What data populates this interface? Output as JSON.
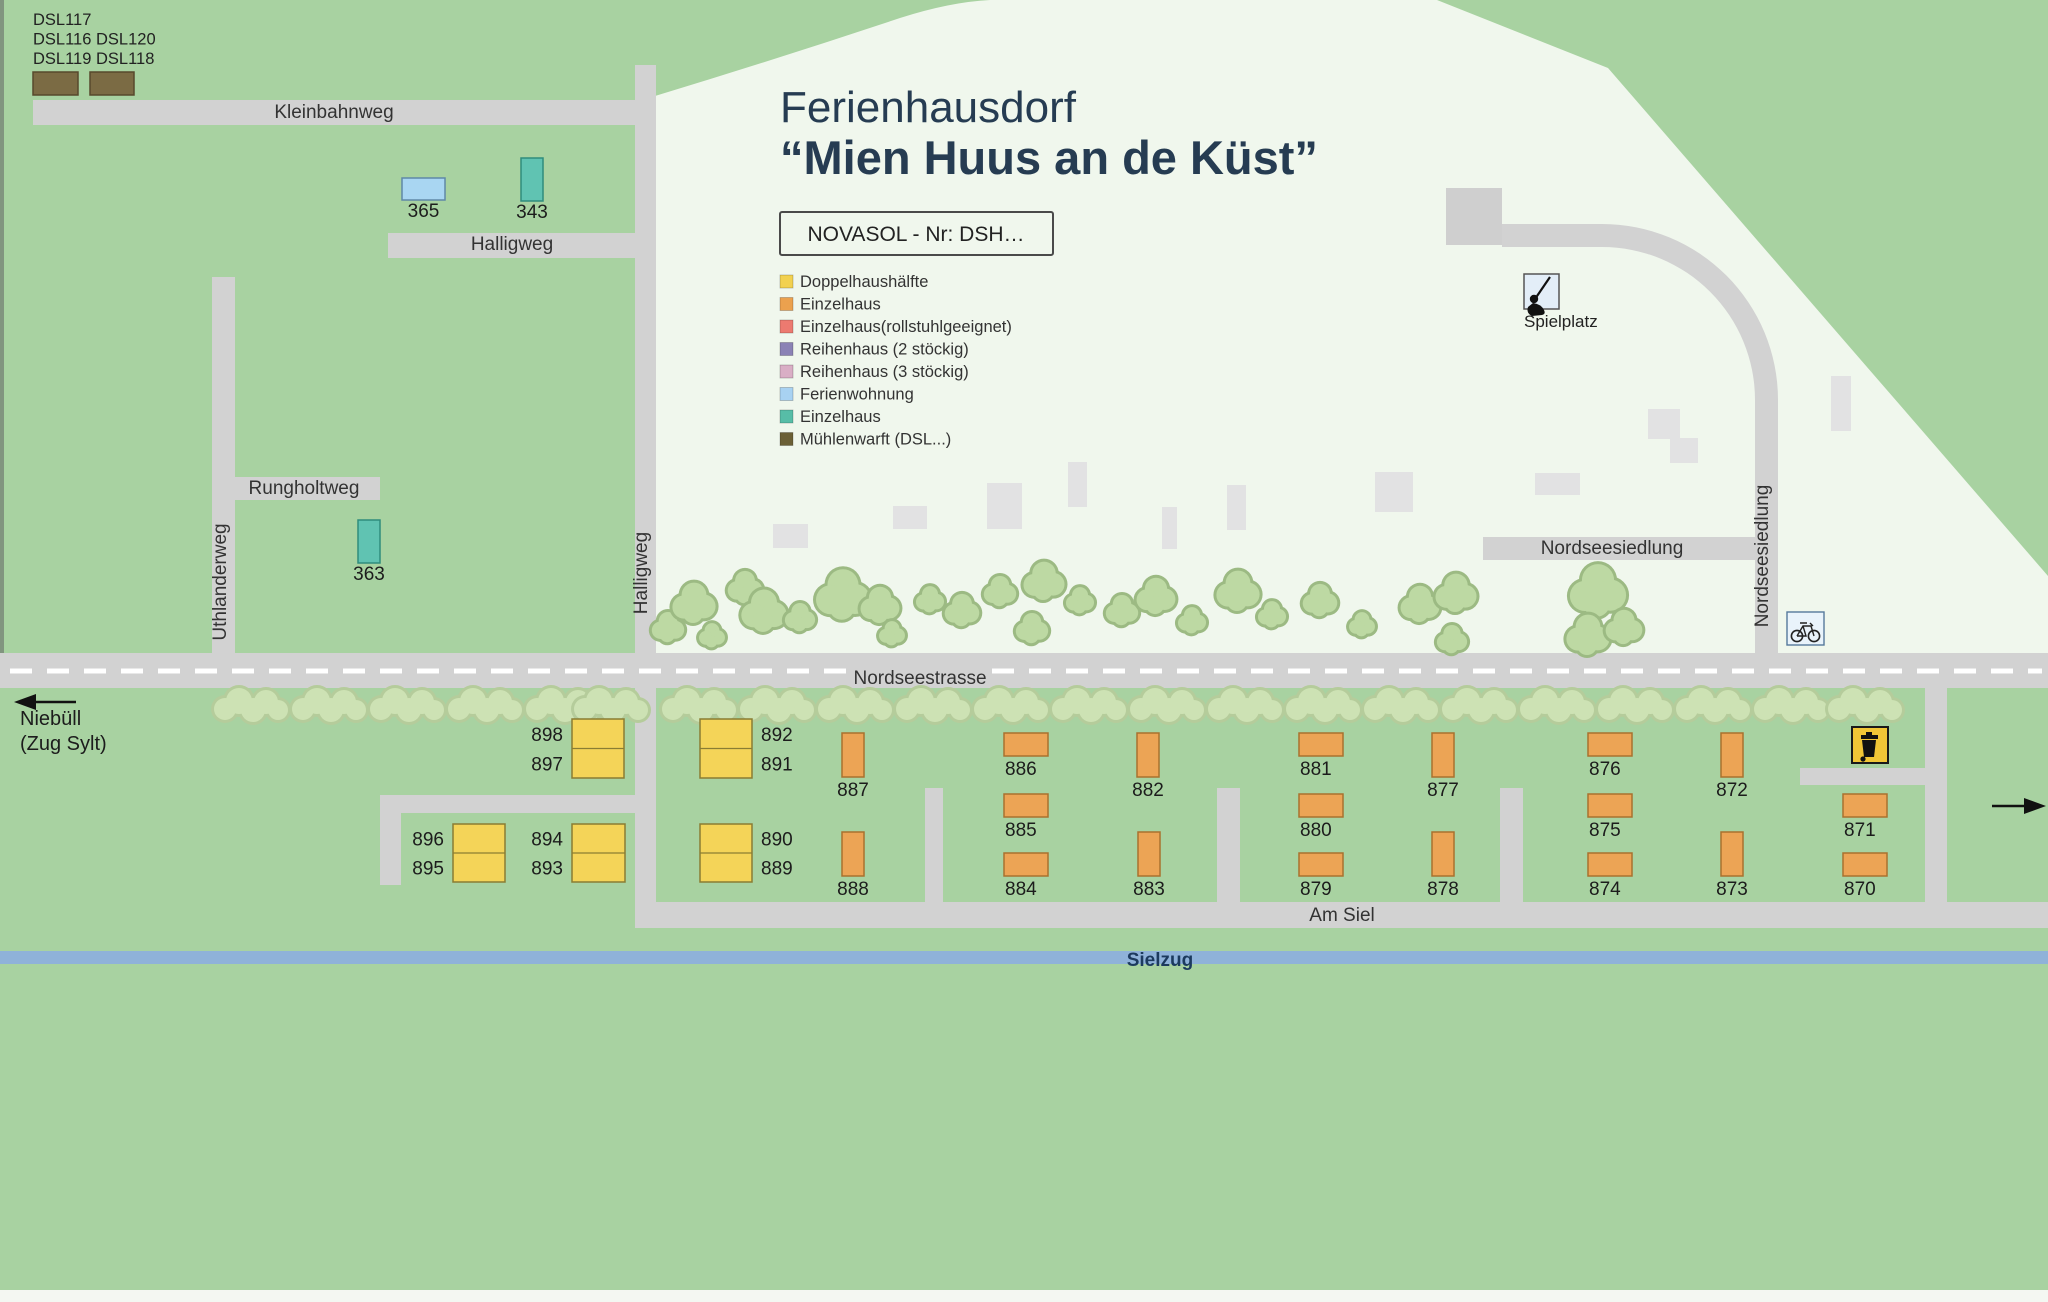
{
  "title": {
    "line1": "Ferienhausdorf",
    "line2": "“Mien Huus an de Küst”"
  },
  "novasol": {
    "label": "NOVASOL - Nr: DSH…"
  },
  "legend": {
    "items": [
      {
        "label": "Doppelhaushälfte",
        "color": "#f2d150"
      },
      {
        "label": "Einzelhaus",
        "color": "#eba14e"
      },
      {
        "label": "Einzelhaus(rollstuhlgeeignet)",
        "color": "#ec7a70"
      },
      {
        "label": "Reihenhaus (2 stöckig)",
        "color": "#8b82b5"
      },
      {
        "label": "Reihenhaus (3 stöckig)",
        "color": "#d9aec5"
      },
      {
        "label": "Ferienwohnung",
        "color": "#a8d2f2"
      },
      {
        "label": "Einzelhaus",
        "color": "#57bda7"
      },
      {
        "label": "Mühlenwarft (DSL...)",
        "color": "#6b6036"
      }
    ]
  },
  "dsl_block": {
    "lines": [
      "DSL117",
      "DSL116 DSL120",
      "DSL119 DSL118"
    ]
  },
  "directions": {
    "west_line1": "Niebüll",
    "west_line2": "(Zug Sylt)"
  },
  "river": {
    "name": "Sielzug"
  },
  "pois": {
    "playground": {
      "label": "Spielplatz"
    }
  },
  "streets": [
    {
      "id": "kleinbahnweg",
      "name": "Kleinbahnweg",
      "label": {
        "x": 334,
        "y": 118,
        "rotate": 0
      }
    },
    {
      "id": "halligweg-h",
      "name": "Halligweg",
      "label": {
        "x": 512,
        "y": 250,
        "rotate": 0
      }
    },
    {
      "id": "halligweg-v",
      "name": "Halligweg",
      "label": {
        "x": 647,
        "y": 573,
        "rotate": -90
      }
    },
    {
      "id": "rungholtweg",
      "name": "Rungholtweg",
      "label": {
        "x": 304,
        "y": 494,
        "rotate": 0
      }
    },
    {
      "id": "uthlanderweg",
      "name": "Uthlanderweg",
      "label": {
        "x": 226,
        "y": 582,
        "rotate": -90
      }
    },
    {
      "id": "nordseestrasse",
      "name": "Nordseestrasse",
      "label": {
        "x": 920,
        "y": 684,
        "rotate": 0
      }
    },
    {
      "id": "nordseesiedlung-h",
      "name": "Nordseesiedlung",
      "label": {
        "x": 1612,
        "y": 554,
        "rotate": 0
      }
    },
    {
      "id": "nordseesiedlung-v",
      "name": "Nordseesiedlung",
      "label": {
        "x": 1768,
        "y": 556,
        "rotate": -90
      }
    },
    {
      "id": "am-siel",
      "name": "Am Siel",
      "label": {
        "x": 1342,
        "y": 921,
        "rotate": 0
      }
    }
  ],
  "houses": {
    "yellow_pairs": [
      {
        "top": "898",
        "bottom": "897",
        "x": 572,
        "y": 719,
        "w": 52,
        "h": 59,
        "side": "left"
      },
      {
        "top": "896",
        "bottom": "895",
        "x": 453,
        "y": 824,
        "w": 52,
        "h": 58,
        "side": "left"
      },
      {
        "top": "894",
        "bottom": "893",
        "x": 572,
        "y": 824,
        "w": 53,
        "h": 58,
        "side": "left"
      },
      {
        "top": "892",
        "bottom": "891",
        "x": 700,
        "y": 719,
        "w": 52,
        "h": 59,
        "side": "right"
      },
      {
        "top": "890",
        "bottom": "889",
        "x": 700,
        "y": 824,
        "w": 52,
        "h": 58,
        "side": "right"
      }
    ],
    "orange_vertical": [
      {
        "n": "887",
        "x": 842,
        "y": 733
      },
      {
        "n": "888",
        "x": 842,
        "y": 832
      },
      {
        "n": "882",
        "x": 1137,
        "y": 733
      },
      {
        "n": "883",
        "x": 1138,
        "y": 832
      },
      {
        "n": "877",
        "x": 1432,
        "y": 733
      },
      {
        "n": "878",
        "x": 1432,
        "y": 832
      },
      {
        "n": "872",
        "x": 1721,
        "y": 733
      },
      {
        "n": "873",
        "x": 1721,
        "y": 832
      }
    ],
    "orange_horizontal": [
      {
        "n": "886",
        "x": 1004,
        "y": 733
      },
      {
        "n": "885",
        "x": 1004,
        "y": 794
      },
      {
        "n": "884",
        "x": 1004,
        "y": 853
      },
      {
        "n": "881",
        "x": 1299,
        "y": 733
      },
      {
        "n": "880",
        "x": 1299,
        "y": 794
      },
      {
        "n": "879",
        "x": 1299,
        "y": 853
      },
      {
        "n": "876",
        "x": 1588,
        "y": 733
      },
      {
        "n": "875",
        "x": 1588,
        "y": 794
      },
      {
        "n": "874",
        "x": 1588,
        "y": 853
      },
      {
        "n": "871",
        "x": 1843,
        "y": 794
      },
      {
        "n": "870",
        "x": 1843,
        "y": 853
      }
    ],
    "teal_houses": [
      {
        "n": "343",
        "x": 521,
        "y": 158,
        "w": 22,
        "h": 43
      },
      {
        "n": "363",
        "x": 358,
        "y": 520,
        "w": 22,
        "h": 43
      }
    ],
    "blue_houses": [
      {
        "n": "365",
        "x": 402,
        "y": 178,
        "w": 43,
        "h": 22
      }
    ],
    "brown_houses": [
      {
        "x": 33,
        "y": 72,
        "w": 45,
        "h": 23
      },
      {
        "x": 90,
        "y": 72,
        "w": 44,
        "h": 23
      }
    ]
  },
  "colors": {
    "map_green": "#a8d2a1",
    "white_area": "#f0f7ed",
    "road": "#d2d2d2",
    "building": "#e2e2e3",
    "river": "#8fb2d9",
    "river_text": "#1c3a5e",
    "title_text": "#263c52",
    "street_text": "#333333",
    "house_text": "#1c1c1c",
    "yellow_fill": "#f4d458",
    "yellow_stroke": "#8a7d33",
    "orange_fill": "#eca455",
    "orange_stroke": "#a9712e",
    "teal_fill": "#60c3b2",
    "teal_stroke": "#2f8d7c",
    "blue_fill": "#a9d6f2",
    "blue_stroke": "#5f88a8",
    "brown_fill": "#7b6b44",
    "brown_stroke": "#57492c",
    "tree_upper_fill": "#bdd9a3",
    "tree_upper_stroke": "#9cba83",
    "tree_lower_fill": "#cde2b4",
    "tree_lower_stroke": "#b5cc9b",
    "trash_yellow": "#f1c636"
  }
}
